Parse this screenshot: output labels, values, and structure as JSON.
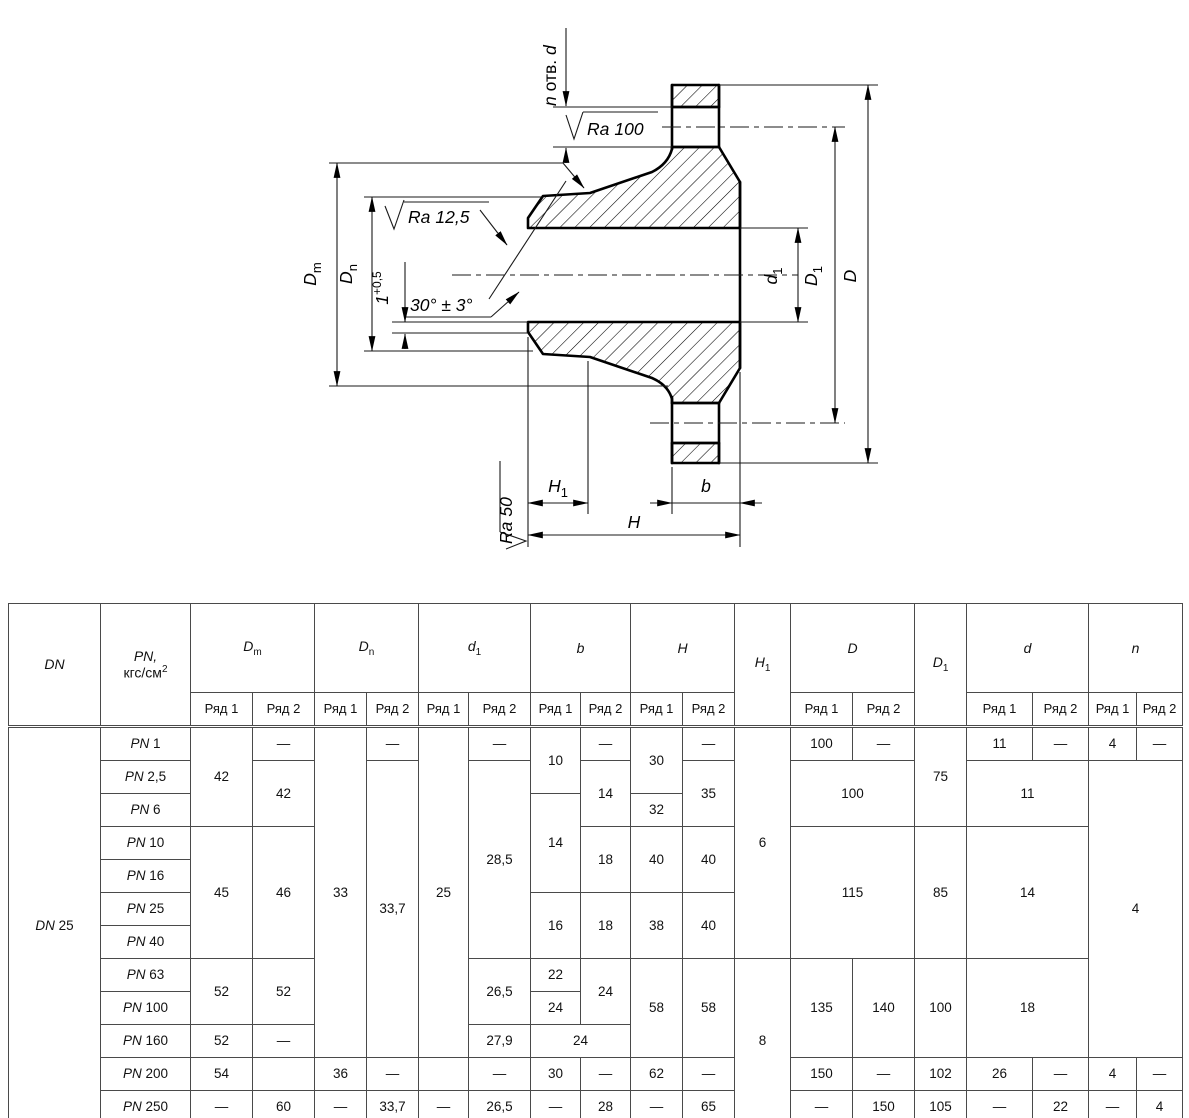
{
  "drawing": {
    "surface_marks": {
      "ra100": {
        "sym": "Ra",
        "val": "100"
      },
      "ra125": {
        "sym": "Ra",
        "val": "12,5"
      },
      "ra50": {
        "sym": "Ra",
        "val": "50"
      }
    },
    "labels": {
      "holes": {
        "n": "n",
        "otv": " отв. ",
        "d": "d"
      },
      "angle": "30° ± 3°",
      "lip": {
        "base": "1",
        "sup": "+0,5"
      },
      "dm": {
        "base": "D",
        "sub": "m"
      },
      "dn": {
        "base": "D",
        "sub": "n"
      },
      "d1": {
        "base": "d",
        "sub": "1"
      },
      "dd1": {
        "base": "D",
        "sub": "1"
      },
      "dd": {
        "base": "D"
      },
      "h": {
        "base": "H"
      },
      "h1": {
        "base": "H",
        "sub": "1"
      },
      "b": {
        "base": "b"
      }
    }
  },
  "table": {
    "header_rows": [
      [
        {
          "parts": [
            {
              "t": "DN",
              "i": 1
            }
          ],
          "rs": 2
        },
        {
          "parts": [
            {
              "t": "PN,",
              "i": 1
            },
            {
              "br": 1
            },
            {
              "t": "кгс/см"
            },
            {
              "t": "2",
              "sup": 1
            }
          ],
          "rs": 2
        },
        {
          "parts": [
            {
              "t": "D",
              "i": 1
            },
            {
              "t": "m",
              "sub": 1
            }
          ],
          "cs": 2
        },
        {
          "parts": [
            {
              "t": "D",
              "i": 1
            },
            {
              "t": "n",
              "sub": 1
            }
          ],
          "cs": 2
        },
        {
          "parts": [
            {
              "t": "d",
              "i": 1
            },
            {
              "t": "1",
              "sub": 1
            }
          ],
          "cs": 2
        },
        {
          "parts": [
            {
              "t": "b",
              "i": 1
            }
          ],
          "cs": 2
        },
        {
          "parts": [
            {
              "t": "H",
              "i": 1
            }
          ],
          "cs": 2
        },
        {
          "parts": [
            {
              "t": "H",
              "i": 1
            },
            {
              "t": "1",
              "sub": 1
            }
          ],
          "rs": 2
        },
        {
          "parts": [
            {
              "t": "D",
              "i": 1
            }
          ],
          "cs": 2
        },
        {
          "parts": [
            {
              "t": "D",
              "i": 1
            },
            {
              "t": "1",
              "sub": 1
            }
          ],
          "rs": 2
        },
        {
          "parts": [
            {
              "t": "d",
              "i": 1
            }
          ],
          "cs": 2
        },
        {
          "parts": [
            {
              "t": "n",
              "i": 1
            }
          ],
          "cs": 2
        }
      ],
      [
        {
          "t": "Ряд 1"
        },
        {
          "t": "Ряд 2"
        },
        {
          "t": "Ряд 1"
        },
        {
          "t": "Ряд 2"
        },
        {
          "t": "Ряд 1"
        },
        {
          "t": "Ряд 2"
        },
        {
          "t": "Ряд 1"
        },
        {
          "t": "Ряд 2"
        },
        {
          "t": "Ряд 1"
        },
        {
          "t": "Ряд 2"
        },
        {
          "t": "Ряд 1"
        },
        {
          "t": "Ряд 2"
        },
        {
          "t": "Ряд 1"
        },
        {
          "t": "Ряд 2"
        },
        {
          "t": "Ряд 1"
        },
        {
          "t": "Ряд 2"
        }
      ]
    ],
    "rows": [
      [
        {
          "parts": [
            {
              "t": "DN",
              "i": 1
            },
            {
              "t": " 25"
            }
          ],
          "rs": 12
        },
        {
          "parts": [
            {
              "t": "PN",
              "i": 1
            },
            {
              "t": " 1"
            }
          ]
        },
        {
          "t": "42",
          "rs": 3
        },
        {
          "t": "—"
        },
        {
          "t": "33",
          "rs": 10
        },
        {
          "t": "—"
        },
        {
          "t": "25",
          "rs": 10
        },
        {
          "t": "—"
        },
        {
          "t": "10",
          "rs": 2
        },
        {
          "t": "—"
        },
        {
          "t": "30",
          "rs": 2
        },
        {
          "t": "—"
        },
        {
          "t": "6",
          "rs": 7
        },
        {
          "t": "100"
        },
        {
          "t": "—"
        },
        {
          "t": "75",
          "rs": 3
        },
        {
          "t": "11"
        },
        {
          "t": "—"
        },
        {
          "t": "4"
        },
        {
          "t": "—"
        }
      ],
      [
        {
          "parts": [
            {
              "t": "PN",
              "i": 1
            },
            {
              "t": " 2,5"
            }
          ]
        },
        {
          "t": "42",
          "rs": 2
        },
        {
          "t": "33,7",
          "rs": 9
        },
        {
          "t": "28,5",
          "rs": 6
        },
        {
          "t": "14",
          "rs": 2
        },
        {
          "t": "35",
          "rs": 2
        },
        {
          "t": "100",
          "cs": 2,
          "rs": 2
        },
        {
          "t": "11",
          "cs": 2,
          "rs": 2
        },
        {
          "t": "4",
          "cs": 2,
          "rs": 9
        }
      ],
      [
        {
          "parts": [
            {
              "t": "PN",
              "i": 1
            },
            {
              "t": " 6"
            }
          ]
        },
        {
          "t": "14",
          "rs": 3
        },
        {
          "t": "32"
        }
      ],
      [
        {
          "parts": [
            {
              "t": "PN",
              "i": 1
            },
            {
              "t": " 10"
            }
          ]
        },
        {
          "t": "45",
          "rs": 4
        },
        {
          "t": "46",
          "rs": 4
        },
        {
          "t": "18",
          "rs": 2
        },
        {
          "t": "40",
          "rs": 2
        },
        {
          "t": "40",
          "rs": 2
        },
        {
          "t": "115",
          "cs": 2,
          "rs": 4
        },
        {
          "t": "85",
          "rs": 4
        },
        {
          "t": "14",
          "cs": 2,
          "rs": 4
        }
      ],
      [
        {
          "parts": [
            {
              "t": "PN",
              "i": 1
            },
            {
              "t": " 16"
            }
          ]
        }
      ],
      [
        {
          "parts": [
            {
              "t": "PN",
              "i": 1
            },
            {
              "t": " 25"
            }
          ]
        },
        {
          "t": "16",
          "rs": 2
        },
        {
          "t": "18",
          "rs": 2
        },
        {
          "t": "38",
          "rs": 2
        },
        {
          "t": "40",
          "rs": 2
        }
      ],
      [
        {
          "parts": [
            {
              "t": "PN",
              "i": 1
            },
            {
              "t": " 40"
            }
          ]
        }
      ],
      [
        {
          "parts": [
            {
              "t": "PN",
              "i": 1
            },
            {
              "t": " 63"
            }
          ]
        },
        {
          "t": "52",
          "rs": 2
        },
        {
          "t": "52",
          "rs": 2
        },
        {
          "t": "26,5",
          "rs": 2
        },
        {
          "t": "22"
        },
        {
          "t": "24",
          "rs": 2
        },
        {
          "t": "58",
          "rs": 3
        },
        {
          "t": "58",
          "rs": 3
        },
        {
          "t": "8",
          "rs": 5
        },
        {
          "t": "135",
          "rs": 3
        },
        {
          "t": "140",
          "rs": 3
        },
        {
          "t": "100",
          "rs": 3
        },
        {
          "t": "18",
          "cs": 2,
          "rs": 3
        }
      ],
      [
        {
          "parts": [
            {
              "t": "PN",
              "i": 1
            },
            {
              "t": " 100"
            }
          ]
        },
        {
          "t": "24"
        }
      ],
      [
        {
          "parts": [
            {
              "t": "PN",
              "i": 1
            },
            {
              "t": " 160"
            }
          ]
        },
        {
          "t": "52"
        },
        {
          "t": "—"
        },
        {
          "t": "27,9"
        },
        {
          "t": "24",
          "cs": 2
        }
      ],
      [
        {
          "parts": [
            {
              "t": "PN",
              "i": 1
            },
            {
              "t": " 200"
            }
          ]
        },
        {
          "t": "54"
        },
        {
          "t": ""
        },
        {
          "t": "36"
        },
        {
          "t": "—"
        },
        {
          "t": ""
        },
        {
          "t": "—"
        },
        {
          "t": "30"
        },
        {
          "t": "—"
        },
        {
          "t": "62"
        },
        {
          "t": "—"
        },
        {
          "t": "150"
        },
        {
          "t": "—"
        },
        {
          "t": "102"
        },
        {
          "t": "26"
        },
        {
          "t": "—"
        },
        {
          "t": "4"
        },
        {
          "t": "—"
        }
      ],
      [
        {
          "parts": [
            {
              "t": "PN",
              "i": 1
            },
            {
              "t": " 250"
            }
          ]
        },
        {
          "t": "—"
        },
        {
          "t": "60"
        },
        {
          "t": "—"
        },
        {
          "t": "33,7"
        },
        {
          "t": "—"
        },
        {
          "t": "26,5"
        },
        {
          "t": "—"
        },
        {
          "t": "28"
        },
        {
          "t": "—"
        },
        {
          "t": "65"
        },
        {
          "t": "—"
        },
        {
          "t": "150"
        },
        {
          "t": "105"
        },
        {
          "t": "—"
        },
        {
          "t": "22"
        },
        {
          "t": "—"
        },
        {
          "t": "4"
        }
      ]
    ]
  }
}
